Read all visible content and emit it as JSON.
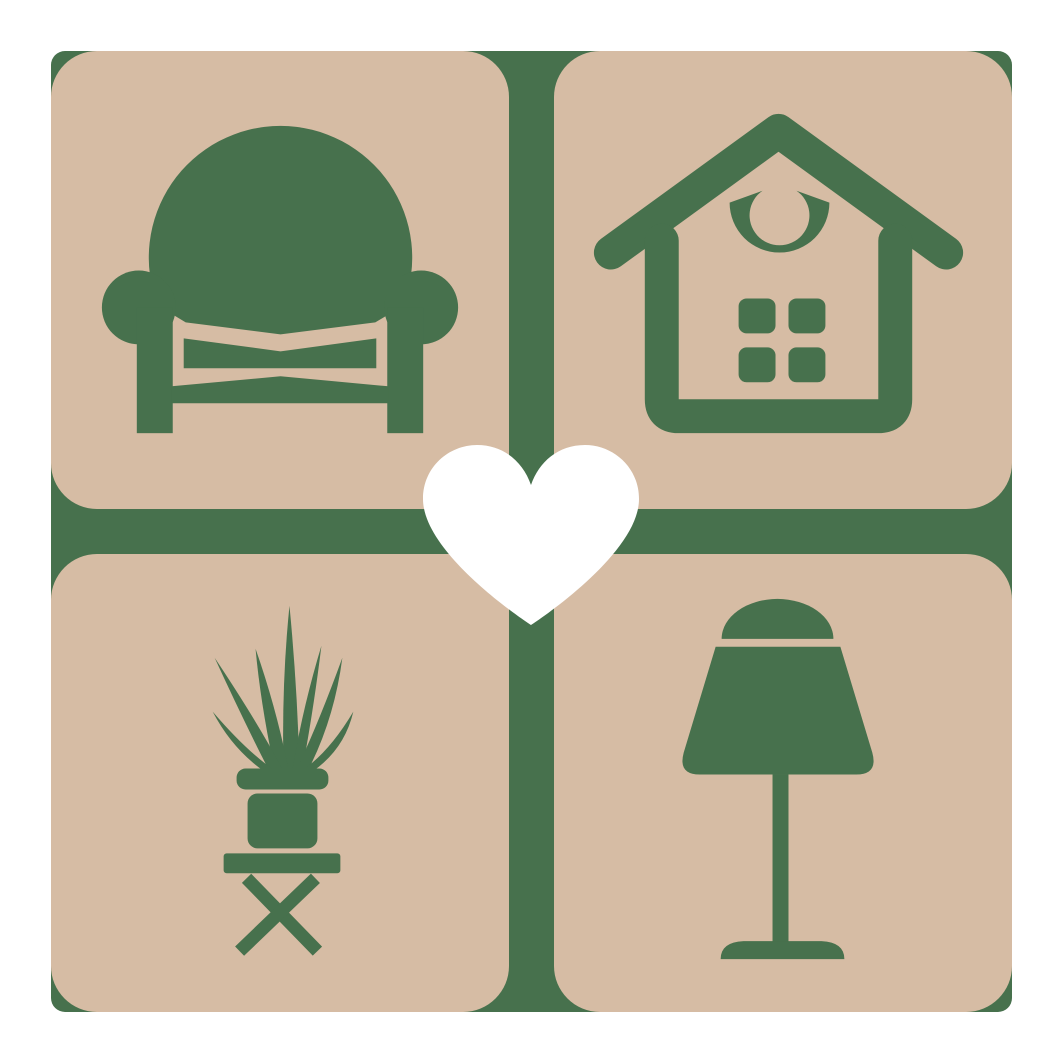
{
  "logo": {
    "title": "Home and furniture logo",
    "colors": {
      "background": "#ffffff",
      "backplate": "#47714d",
      "tile": "#d6bca4",
      "icon": "#47714d",
      "heart": "#ffffff"
    },
    "tiles": [
      {
        "id": "armchair",
        "label": "Armchair"
      },
      {
        "id": "house",
        "label": "House with crescent ornament and four-pane window"
      },
      {
        "id": "plant",
        "label": "Potted plant on folding stool"
      },
      {
        "id": "lamp",
        "label": "Table lamp"
      }
    ],
    "center": {
      "label": "Heart"
    }
  }
}
